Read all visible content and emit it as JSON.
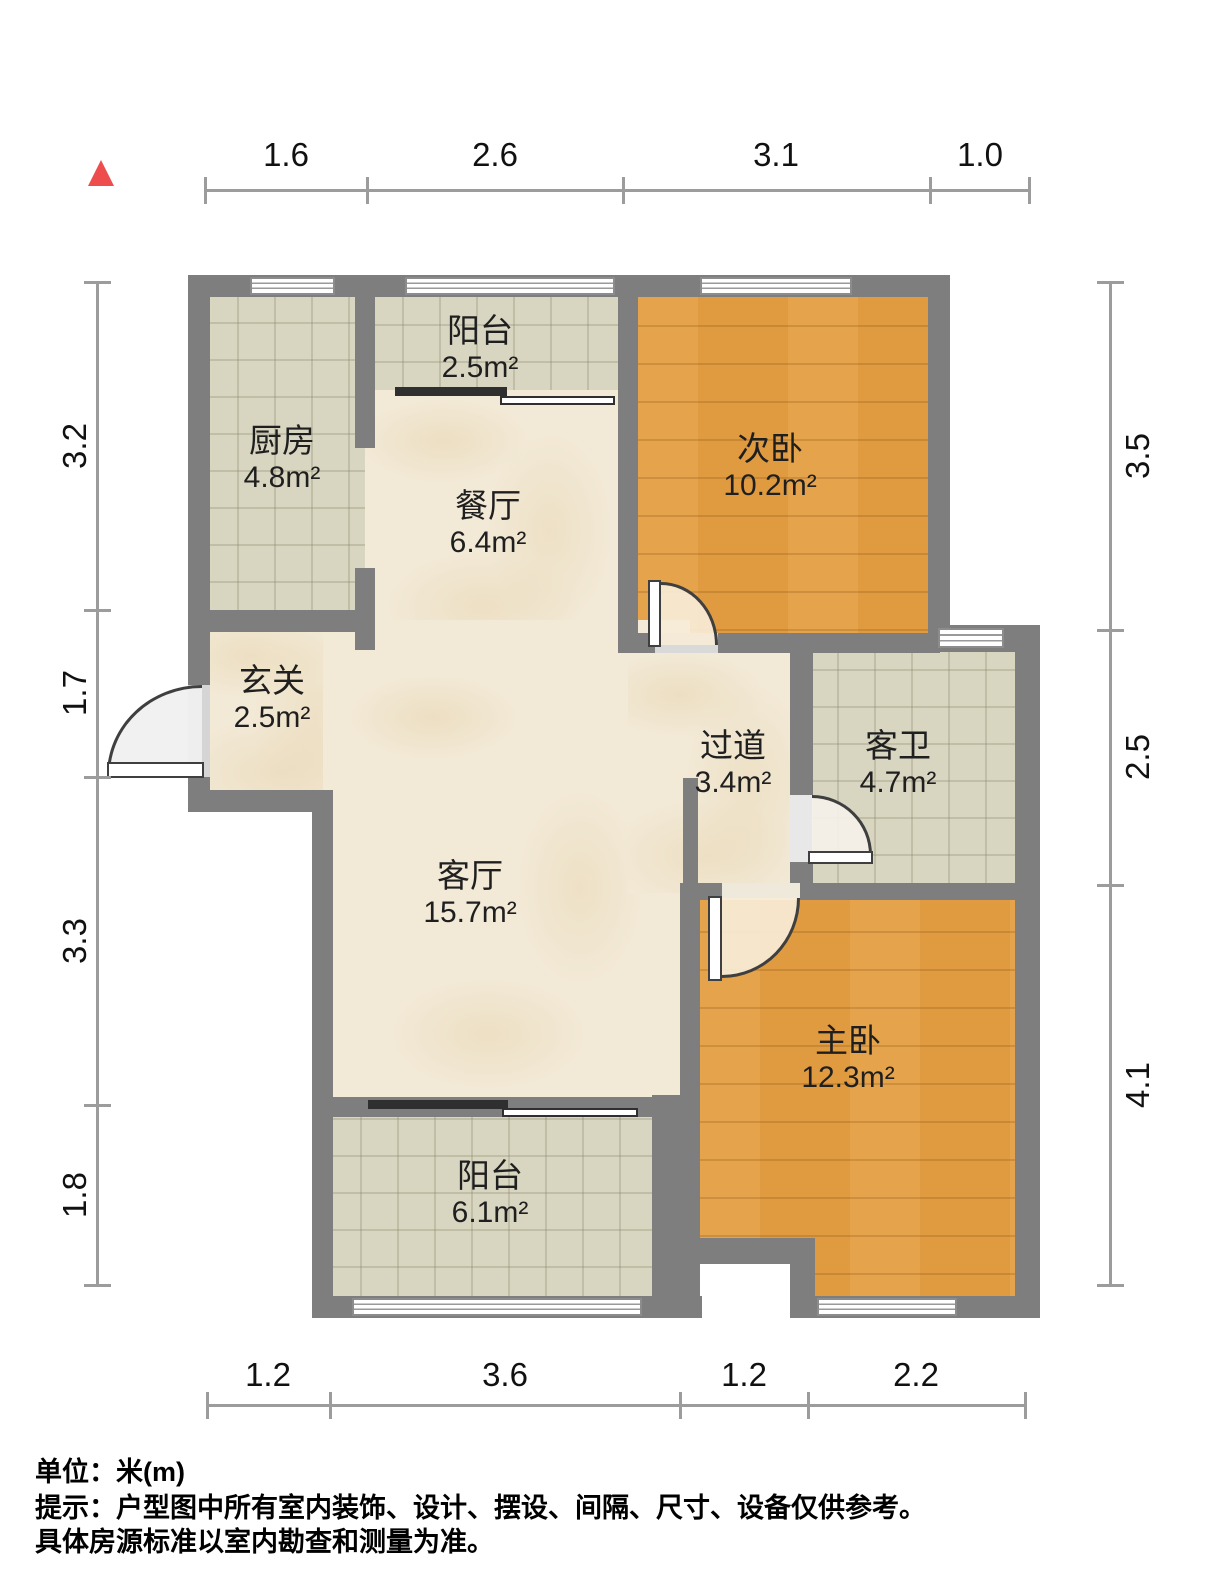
{
  "compass": {
    "icon": "north-triangle",
    "color": "#ee4d4d"
  },
  "dimensions": {
    "top": [
      "1.6",
      "2.6",
      "3.1",
      "1.0"
    ],
    "left": [
      "3.2",
      "1.7",
      "3.3",
      "1.8"
    ],
    "right": [
      "3.5",
      "2.5",
      "4.1"
    ],
    "bottom": [
      "1.2",
      "3.6",
      "1.2",
      "2.2"
    ]
  },
  "rooms": {
    "balcony_top": {
      "name": "阳台",
      "area": "2.5m²"
    },
    "kitchen": {
      "name": "厨房",
      "area": "4.8m²"
    },
    "dining": {
      "name": "餐厅",
      "area": "6.4m²"
    },
    "bedroom_second": {
      "name": "次卧",
      "area": "10.2m²"
    },
    "entry": {
      "name": "玄关",
      "area": "2.5m²"
    },
    "hallway": {
      "name": "过道",
      "area": "3.4m²"
    },
    "bathroom": {
      "name": "客卫",
      "area": "4.7m²"
    },
    "living": {
      "name": "客厅",
      "area": "15.7m²"
    },
    "bedroom_master": {
      "name": "主卧",
      "area": "12.3m²"
    },
    "balcony_bottom": {
      "name": "阳台",
      "area": "6.1m²"
    }
  },
  "footer": {
    "unit_line": "单位：米(m)",
    "note_line1": "提示：户型图中所有室内装饰、设计、摆设、间隔、尺寸、设备仅供参考。",
    "note_line2": "具体房源标准以室内勘查和测量为准。"
  },
  "colors": {
    "wall": "#7e7e7e",
    "wood_floor": "#e09a40",
    "tile_floor": "#d8d5c0",
    "marble_floor": "#f2e9d6",
    "dimension_line": "#9c9c9c",
    "north_marker": "#ee4d4d"
  }
}
